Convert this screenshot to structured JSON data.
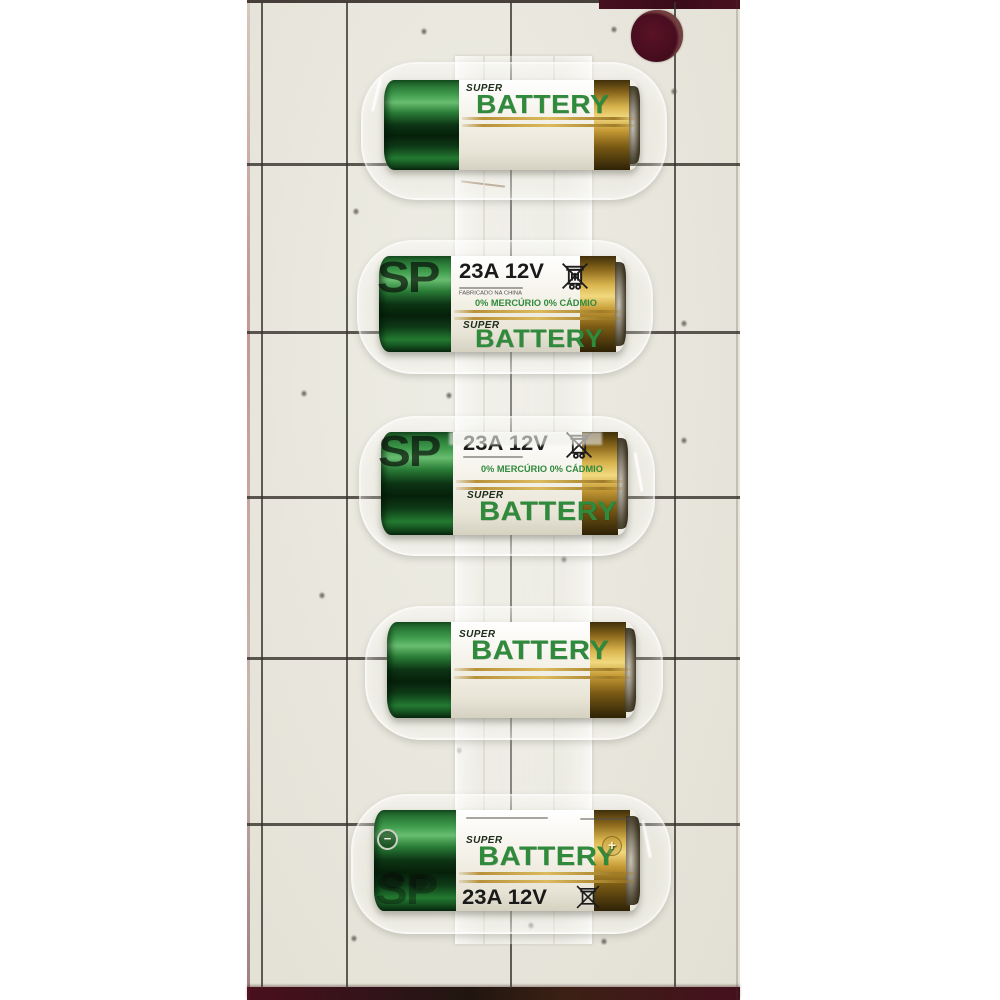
{
  "image": {
    "description": "Retail blister pack photo: five SUPER BATTERY 23A 12V batteries sealed on a cream tiled backing card with a maroon hang hole",
    "battery_count": 5
  },
  "product": {
    "brand_line1": "SUPER",
    "brand_line2": "BATTERY",
    "model_spec": "23A 12V",
    "eco_text": "0% MERCÚRIO 0% CÁDMIO",
    "origin_text": "FABRICADO NA CHINA",
    "card_watermark": "SP",
    "negative_mark": "−",
    "positive_mark": "+"
  },
  "colors": {
    "brand_green": "#2f8a3c",
    "cap_green_dark": "#0a2e10",
    "gold_brass": "#c9a23f",
    "label_white": "#f2efe7",
    "card_cream": "#e8e6dc",
    "grid_line": "#34312a",
    "hang_hole_maroon": "#470d1f",
    "page_white": "#ffffff"
  }
}
